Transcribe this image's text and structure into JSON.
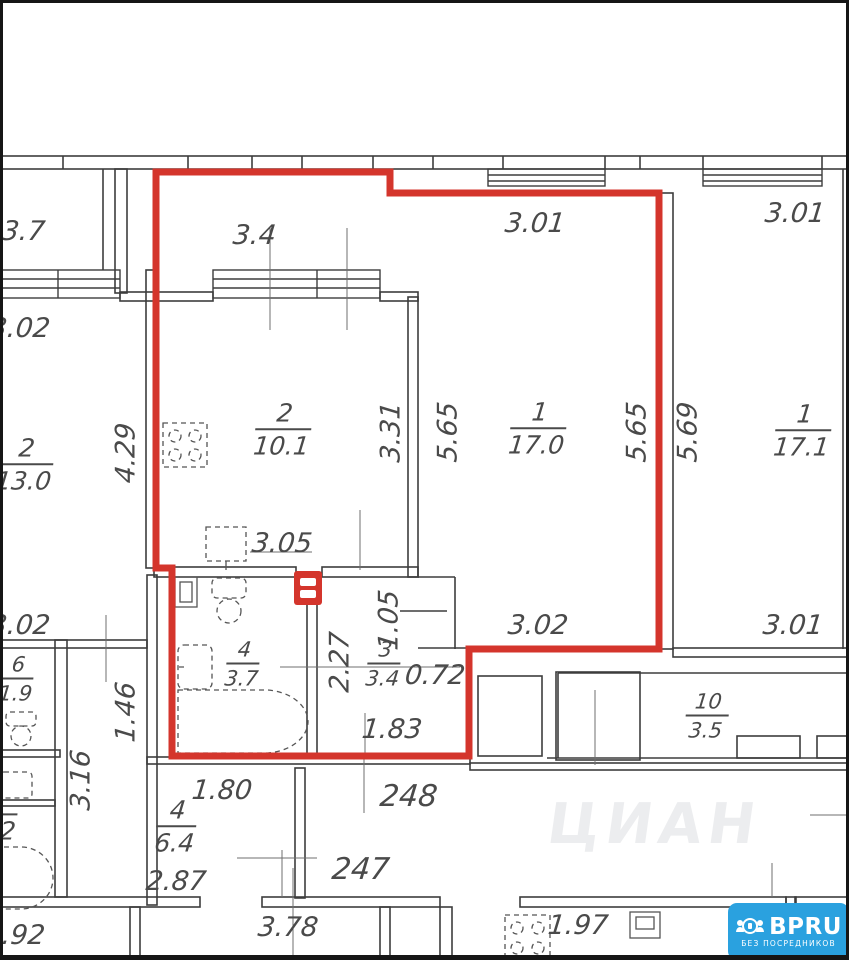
{
  "rooms": [
    {
      "key": "kitchen_selected",
      "number": "2",
      "area": "10.1"
    },
    {
      "key": "living_selected",
      "number": "1",
      "area": "17.0"
    },
    {
      "key": "hall_selected",
      "number": "3",
      "area": "3.4"
    },
    {
      "key": "bath_selected",
      "number": "4",
      "area": "3.7"
    },
    {
      "key": "living_neighbor",
      "number": "1",
      "area": "17.1"
    },
    {
      "key": "kitchen_neighbor",
      "number": "2",
      "area": "13.0"
    },
    {
      "key": "wc_neighbor",
      "number": "6",
      "area": "1.9"
    },
    {
      "key": "room_neighbor_bottom",
      "number": "4",
      "area": "6.4"
    },
    {
      "key": "balcony_neighbor",
      "number": "10",
      "area": "3.5"
    },
    {
      "key": "room_partial_left",
      "number": "",
      "area": "2"
    }
  ],
  "dims": {
    "top_left_room": "3.7",
    "top_left_wall": "3.02",
    "balcony_width": "3.4",
    "living_width_top": "3.01",
    "neighbor_width_top": "3.01",
    "neighbor_width_bottom": "3.01",
    "kitchen_depth": "3.31",
    "living_depth_left": "5.65",
    "living_depth_right": "5.65",
    "neighbor_depth": "5.69",
    "left_depth": "4.29",
    "kitchen_width_bottom": "3.05",
    "niche_depth": "1.05",
    "hall_depth": "2.27",
    "hall_width": "0.72",
    "hall_width_bottom": "1.83",
    "living_width_bottom": "3.02",
    "left_mid_wall": "3.02",
    "left_small_depth": "1.46",
    "left_lower_depth": "3.16",
    "bottom_room_width": "1.80",
    "bottom_room_width_lower": "2.87",
    "bottom_center_width": "3.78",
    "bottom_right_width": "1.97",
    "bottom_left_partial": ".92"
  },
  "units": {
    "first": "248",
    "second": "247"
  },
  "watermark": "ЦИАН",
  "logo": {
    "brand": "BPRU",
    "tagline": "БЕЗ ПОСРЕДНИКОВ"
  },
  "colors": {
    "highlight": "#d4352c",
    "wall": "#3d3d3d",
    "label": "#4a4a4a",
    "logo_bg": "#2aa1df"
  },
  "icons": [
    "stove-icon",
    "kitchen-sink-icon",
    "toilet-icon",
    "washbasin-icon",
    "bathtub-icon",
    "corner-shelf-icon",
    "electrical-panel-icon",
    "toilet-small-icon",
    "washbasin-small-icon",
    "bathtub-small-icon",
    "stove-bottom-icon",
    "sink-bottom-icon"
  ]
}
